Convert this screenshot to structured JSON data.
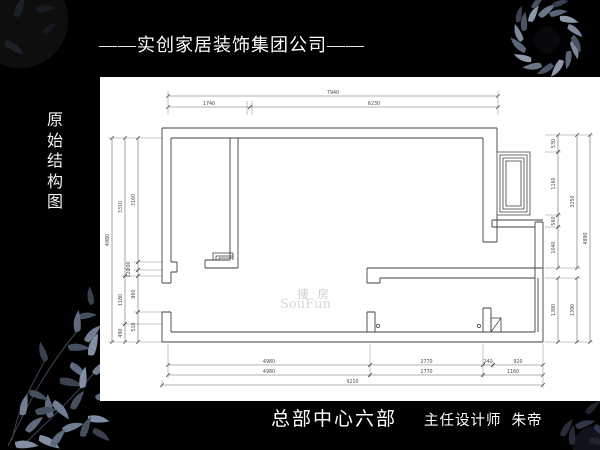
{
  "header": {
    "company_title": "——实创家居装饰集团公司——"
  },
  "side_label": {
    "text": "原始结构图",
    "chars": [
      "原",
      "始",
      "结",
      "构",
      "图"
    ]
  },
  "footer": {
    "department": "总部中心六部",
    "designer_role": "主任设计师",
    "designer_name": "朱帝"
  },
  "watermark": {
    "cn": "搜房",
    "en": "SouFun"
  },
  "plan": {
    "dims": {
      "top": {
        "total": "7940",
        "segments": [
          "1740",
          "6230"
        ]
      },
      "bottom": {
        "row1": [
          "4980",
          "2770",
          "240",
          "920"
        ],
        "row2": [
          "4980",
          "2770",
          "1160"
        ],
        "row3": [
          "9210"
        ]
      },
      "left": {
        "outer": "4980",
        "middle": [
          "3310",
          "1180",
          "490"
        ],
        "inner": [
          "3160",
          "200",
          "120",
          "960",
          "510"
        ]
      },
      "right": {
        "outer": "4890",
        "middle": [
          "3250",
          "1390"
        ],
        "inner": [
          "530",
          "1160",
          "560",
          "1040",
          "1380"
        ]
      }
    }
  },
  "colors": {
    "background": "#000000",
    "panel": "#ffffff",
    "wall_line": "#3f3f44",
    "dim_line": "#666666",
    "dim_text": "#4a4a4a",
    "leaf_accent": "#6b7689",
    "text": "#ffffff"
  }
}
